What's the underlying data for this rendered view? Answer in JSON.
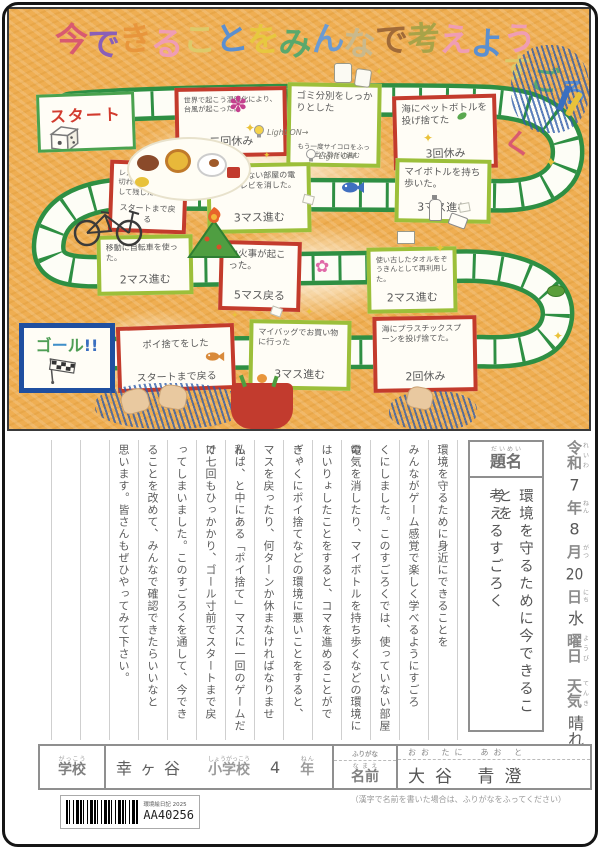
{
  "art": {
    "title_chars": [
      {
        "ch": "今",
        "color": "#d85a70"
      },
      {
        "ch": "で",
        "color": "#8a5fb8"
      },
      {
        "ch": "き",
        "color": "#e8963c"
      },
      {
        "ch": "る",
        "color": "#ef9db4"
      },
      {
        "ch": "こ",
        "color": "#ddca6a"
      },
      {
        "ch": "と",
        "color": "#5b8fd0"
      },
      {
        "ch": "を",
        "color": "#e7c83f"
      },
      {
        "ch": "み",
        "color": "#5aa86c"
      },
      {
        "ch": "ん",
        "color": "#6b9bd2"
      },
      {
        "ch": "な",
        "color": "#c9b98d"
      },
      {
        "ch": "で",
        "color": "#a06a38"
      },
      {
        "ch": "考",
        "color": "#a8a348"
      },
      {
        "ch": "え",
        "color": "#ef9db4"
      },
      {
        "ch": "よ",
        "color": "#5b8fd0"
      },
      {
        "ch": "う",
        "color": "#ef9db4"
      }
    ],
    "subtitle_chars": [
      {
        "ch": "す",
        "color": "#ddca6a"
      },
      {
        "ch": "ご",
        "color": "#5aa86c"
      },
      {
        "ch": "ろ",
        "color": "#5b8fd0"
      },
      {
        "ch": "く",
        "color": "#d85a70"
      }
    ],
    "start_label": "スタート",
    "goal_chars": [
      {
        "ch": "ゴ",
        "color": "#4f9e55"
      },
      {
        "ch": "ー",
        "color": "#3f8fc9"
      },
      {
        "ch": "ル",
        "color": "#4f9e55"
      },
      {
        "ch": "!!",
        "color": "#3a6fc0"
      }
    ],
    "lights": {
      "on": "Light ON→",
      "off": "Light OFF"
    },
    "icons": {
      "sparkle": "✦",
      "flower": "✽",
      "blossom": "✿"
    },
    "cards": {
      "typhoon": {
        "body": "世界で起こう温暖化により、台風が起こった。",
        "action": "二回休み"
      },
      "sort": {
        "body": "ゴミ分別をしっかりとした",
        "action": "もう一度サイコロをふって出た数だけ進む"
      },
      "sea_pet": {
        "body": "海にペットボトルを投げ捨てた",
        "action": "3回休み"
      },
      "my_bottle": {
        "body": "マイボトルを持ち歩いた。",
        "action": "3マス進む"
      },
      "room_power": {
        "body": "使っていない部屋の電気やテレビを消した。",
        "action": "3マス進む"
      },
      "restaurant": {
        "body": "レストランで食べ切れない量を注文して残した。",
        "action": "スタートまで戻る"
      },
      "bicycle": {
        "body": "移動に自転車を使った。",
        "action": "2マス進む"
      },
      "wildfire": {
        "body": "山火事が起こった。",
        "action": "5マス戻る"
      },
      "towel": {
        "body": "使い古したタオルをぞうきんとして再利用した。",
        "action": "2マス進む"
      },
      "litter": {
        "body": "ポイ捨てをした",
        "action": "スタートまで戻る"
      },
      "my_bag": {
        "body": "マイバッグでお買い物に行った",
        "action": "3マス進む"
      },
      "plastic_spoon": {
        "body": "海にプラスチックスプーンを投げ捨てた。",
        "action": "2回休み"
      }
    }
  },
  "diary": {
    "date": {
      "era": "令和",
      "era_kana": "れいわ",
      "year": "7",
      "year_unit": "年",
      "year_kana": "ねん",
      "month": "8",
      "month_unit": "月",
      "month_kana": "がつ",
      "day": "20",
      "day_unit": "日",
      "day_kana": "にち",
      "weekday": "水",
      "weekday_unit": "曜日",
      "weekday_kana": "ようび",
      "weather_label": "天気",
      "weather_kana": "てんき",
      "weather": "晴れ"
    },
    "title_label": "題名",
    "title_label_kana": "だいめい",
    "title_lines": [
      "環境を守るために今できることを",
      "考えるすごろく"
    ],
    "essay_columns": [
      "環境を守るために身近にできることを",
      "みんながゲーム感覚で楽しく学べるようにすごろ",
      "くにしました。このすごろくでは、使っていない部屋の",
      "電気を消したり、マイボトルを持ち歩くなどの環境に",
      "はいりょしたことをすると、コマを進めることができ、",
      "ぎゃくにポイ捨てなどの環境に悪いことをすると、",
      "マスを戻ったり、何ターンか休まなければなりません。",
      "私は、と中にある「ポイ捨て」マスに一回のゲームだけ",
      "で七回もひっかかり、ゴール寸前でスタートまで戻",
      "ってしまいました。このすごろくを通して、今でき",
      "ることを改めて、みんなで確認できたらいいなと",
      "思います。皆さんもぜひやってみて下さい。"
    ]
  },
  "footer": {
    "school": {
      "label": "学校",
      "label_kana": "がっこう",
      "value": "幸ヶ谷",
      "type": "小学校",
      "type_kana": "しょうがっこう",
      "grade": "4",
      "grade_unit": "年",
      "grade_unit_kana": "ねん"
    },
    "name": {
      "furigana_label": "ふりがな",
      "furigana": "おお たに　あお と",
      "label": "名前",
      "label_kana": "なまえ",
      "value": "大谷 青澄"
    },
    "note": "（漢字で名前を書いた場合は、ふりがなをふってください）",
    "barcode": {
      "label": "環境絵日記 2025",
      "code": "AA40256"
    }
  }
}
